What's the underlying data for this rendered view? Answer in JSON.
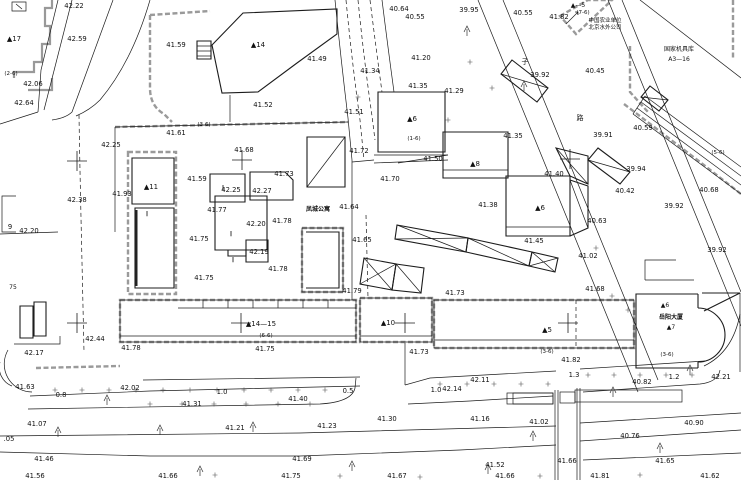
{
  "drawing": {
    "type": "cadastral-survey-plan",
    "colors": {
      "background": "#ffffff",
      "ink": "#1c1c1c",
      "screen_gray": "#9a9a9a"
    },
    "labels": [
      {
        "t": "42.22",
        "x": 74,
        "y": 8
      },
      {
        "t": "42.59",
        "x": 77,
        "y": 41
      },
      {
        "t": "▲17",
        "x": 14,
        "y": 41,
        "s": 7
      },
      {
        "t": "(2-6)",
        "x": 11,
        "y": 75,
        "s": 5.5
      },
      {
        "t": "42.06",
        "x": 33,
        "y": 86
      },
      {
        "t": "42.64",
        "x": 24,
        "y": 105
      },
      {
        "t": "41.59",
        "x": 176,
        "y": 47
      },
      {
        "t": "▲14",
        "x": 258,
        "y": 47,
        "s": 7
      },
      {
        "t": "(3-6)",
        "x": 204,
        "y": 126,
        "s": 5.5
      },
      {
        "t": "41.61",
        "x": 176,
        "y": 135
      },
      {
        "t": "42.25",
        "x": 111,
        "y": 147
      },
      {
        "t": "41.49",
        "x": 317,
        "y": 61
      },
      {
        "t": "41.52",
        "x": 263,
        "y": 107
      },
      {
        "t": "41.51",
        "x": 354,
        "y": 114
      },
      {
        "t": "42.38",
        "x": 77,
        "y": 202
      },
      {
        "t": "42.20",
        "x": 29,
        "y": 233
      },
      {
        "t": "41.93",
        "x": 122,
        "y": 196
      },
      {
        "t": "▲11",
        "x": 151,
        "y": 189,
        "s": 7
      },
      {
        "t": "9",
        "x": 10,
        "y": 229
      },
      {
        "t": "75",
        "x": 13,
        "y": 289,
        "s": 6
      },
      {
        "t": "41.59",
        "x": 197,
        "y": 181
      },
      {
        "t": "42.25",
        "x": 231,
        "y": 192
      },
      {
        "t": "42.27",
        "x": 262,
        "y": 193
      },
      {
        "t": "41.77",
        "x": 217,
        "y": 212
      },
      {
        "t": "42.20",
        "x": 256,
        "y": 226
      },
      {
        "t": "41.78",
        "x": 282,
        "y": 223
      },
      {
        "t": "41.75",
        "x": 199,
        "y": 241
      },
      {
        "t": "42.19",
        "x": 259,
        "y": 254
      },
      {
        "t": "41.78",
        "x": 278,
        "y": 271
      },
      {
        "t": "41.75",
        "x": 204,
        "y": 280
      },
      {
        "t": "41.68",
        "x": 244,
        "y": 152
      },
      {
        "t": "41.73",
        "x": 284,
        "y": 176
      },
      {
        "t": "凤城公寓",
        "x": 318,
        "y": 211,
        "s": 6,
        "w": "bold"
      },
      {
        "t": "41.64",
        "x": 349,
        "y": 209
      },
      {
        "t": "41.72",
        "x": 359,
        "y": 153
      },
      {
        "t": "41.70",
        "x": 390,
        "y": 181
      },
      {
        "t": "41.65",
        "x": 362,
        "y": 242
      },
      {
        "t": "41.79",
        "x": 352,
        "y": 293
      },
      {
        "t": "41.73",
        "x": 455,
        "y": 295
      },
      {
        "t": "40.64",
        "x": 399,
        "y": 11
      },
      {
        "t": "40.55",
        "x": 415,
        "y": 19
      },
      {
        "t": "39.95",
        "x": 469,
        "y": 12
      },
      {
        "t": "40.55",
        "x": 523,
        "y": 15
      },
      {
        "t": "41.82",
        "x": 559,
        "y": 19
      },
      {
        "t": "▲—5",
        "x": 578,
        "y": 7,
        "s": 6
      },
      {
        "t": "(7-6)",
        "x": 583,
        "y": 14,
        "s": 5.5
      },
      {
        "t": "中国农业单位",
        "x": 605,
        "y": 22,
        "s": 5.5
      },
      {
        "t": "北京水外公司",
        "x": 605,
        "y": 29,
        "s": 5.5
      },
      {
        "t": "国家机具库",
        "x": 679,
        "y": 51,
        "s": 6
      },
      {
        "t": "A3—16",
        "x": 679,
        "y": 61,
        "s": 6
      },
      {
        "t": "41.34",
        "x": 370,
        "y": 73
      },
      {
        "t": "41.20",
        "x": 421,
        "y": 60
      },
      {
        "t": "41.29",
        "x": 454,
        "y": 93
      },
      {
        "t": "41.35",
        "x": 418,
        "y": 88
      },
      {
        "t": "▲6",
        "x": 412,
        "y": 121,
        "s": 7
      },
      {
        "t": "41.35",
        "x": 513,
        "y": 138
      },
      {
        "t": "(1-6)",
        "x": 414,
        "y": 140,
        "s": 5.5
      },
      {
        "t": "41.50",
        "x": 433,
        "y": 161
      },
      {
        "t": "▲8",
        "x": 475,
        "y": 166,
        "s": 7
      },
      {
        "t": "41.40",
        "x": 554,
        "y": 176
      },
      {
        "t": "41.38",
        "x": 488,
        "y": 207
      },
      {
        "t": "▲6",
        "x": 540,
        "y": 210,
        "s": 7
      },
      {
        "t": "41.45",
        "x": 534,
        "y": 243
      },
      {
        "t": "41.02",
        "x": 588,
        "y": 258
      },
      {
        "t": "39.92",
        "x": 540,
        "y": 77
      },
      {
        "t": "子",
        "x": 525,
        "y": 64,
        "s": 7
      },
      {
        "t": "路",
        "x": 580,
        "y": 120,
        "s": 7
      },
      {
        "t": "40.45",
        "x": 595,
        "y": 73
      },
      {
        "t": "39.91",
        "x": 603,
        "y": 137
      },
      {
        "t": "40.59",
        "x": 643,
        "y": 130
      },
      {
        "t": "39.94",
        "x": 636,
        "y": 171
      },
      {
        "t": "40.42",
        "x": 625,
        "y": 193
      },
      {
        "t": "39.92",
        "x": 674,
        "y": 208
      },
      {
        "t": "40.68",
        "x": 709,
        "y": 192
      },
      {
        "t": "39.92",
        "x": 717,
        "y": 252
      },
      {
        "t": "(5-6)",
        "x": 718,
        "y": 154,
        "s": 5.5
      },
      {
        "t": "40.63",
        "x": 597,
        "y": 223
      },
      {
        "t": "41.68",
        "x": 595,
        "y": 291
      },
      {
        "t": "42.44",
        "x": 95,
        "y": 341
      },
      {
        "t": "42.17",
        "x": 34,
        "y": 355
      },
      {
        "t": "41.78",
        "x": 131,
        "y": 350
      },
      {
        "t": "41.63",
        "x": 25,
        "y": 389
      },
      {
        "t": "42.02",
        "x": 130,
        "y": 390
      },
      {
        "t": "0.8",
        "x": 61,
        "y": 397
      },
      {
        "t": "1.0",
        "x": 222,
        "y": 394
      },
      {
        "t": "41.31",
        "x": 192,
        "y": 406
      },
      {
        "t": "41.07",
        "x": 37,
        "y": 426
      },
      {
        "t": "41.21",
        "x": 235,
        "y": 430
      },
      {
        "t": ".05",
        "x": 9,
        "y": 441
      },
      {
        "t": "41.46",
        "x": 44,
        "y": 461
      },
      {
        "t": "41.56",
        "x": 35,
        "y": 478
      },
      {
        "t": "41.66",
        "x": 168,
        "y": 478
      },
      {
        "t": "▲14—15",
        "x": 261,
        "y": 326,
        "s": 7
      },
      {
        "t": "(6-6)",
        "x": 266,
        "y": 337,
        "s": 5.5
      },
      {
        "t": "41.75",
        "x": 265,
        "y": 351
      },
      {
        "t": "▲10",
        "x": 388,
        "y": 325,
        "s": 7
      },
      {
        "t": "41.73",
        "x": 419,
        "y": 354
      },
      {
        "t": "0.5",
        "x": 348,
        "y": 393
      },
      {
        "t": "41.40",
        "x": 298,
        "y": 401
      },
      {
        "t": "1.0",
        "x": 436,
        "y": 392
      },
      {
        "t": "42.14",
        "x": 452,
        "y": 391
      },
      {
        "t": "42.11",
        "x": 480,
        "y": 382
      },
      {
        "t": "41.30",
        "x": 387,
        "y": 421
      },
      {
        "t": "41.16",
        "x": 480,
        "y": 421
      },
      {
        "t": "41.23",
        "x": 327,
        "y": 428
      },
      {
        "t": "41.69",
        "x": 302,
        "y": 461
      },
      {
        "t": "41.75",
        "x": 291,
        "y": 478
      },
      {
        "t": "41.67",
        "x": 397,
        "y": 478
      },
      {
        "t": "▲5",
        "x": 547,
        "y": 332,
        "s": 7
      },
      {
        "t": "(3-6)",
        "x": 547,
        "y": 353,
        "s": 5.5
      },
      {
        "t": "41.82",
        "x": 571,
        "y": 362
      },
      {
        "t": "▲6",
        "x": 665,
        "y": 307,
        "s": 6
      },
      {
        "t": "岳阳大厦",
        "x": 671,
        "y": 319,
        "s": 6,
        "w": "bold"
      },
      {
        "t": "▲7",
        "x": 671,
        "y": 329,
        "s": 6
      },
      {
        "t": "(3-6)",
        "x": 667,
        "y": 356,
        "s": 5.5
      },
      {
        "t": "1.3",
        "x": 574,
        "y": 377
      },
      {
        "t": "1.2",
        "x": 674,
        "y": 379
      },
      {
        "t": "42.21",
        "x": 721,
        "y": 379
      },
      {
        "t": "40.82",
        "x": 642,
        "y": 384
      },
      {
        "t": "41.02",
        "x": 539,
        "y": 424
      },
      {
        "t": "40.90",
        "x": 694,
        "y": 425
      },
      {
        "t": "40.76",
        "x": 630,
        "y": 438
      },
      {
        "t": "41.52",
        "x": 495,
        "y": 467
      },
      {
        "t": "41.66",
        "x": 567,
        "y": 463
      },
      {
        "t": "41.66",
        "x": 505,
        "y": 478
      },
      {
        "t": "41.81",
        "x": 600,
        "y": 478
      },
      {
        "t": "41.65",
        "x": 665,
        "y": 463
      },
      {
        "t": "41.62",
        "x": 710,
        "y": 478
      },
      {
        "t": "‖",
        "x": 147,
        "y": 215,
        "s": 5
      },
      {
        "t": "‖",
        "x": 223,
        "y": 189,
        "s": 5
      },
      {
        "t": "‖",
        "x": 231,
        "y": 235,
        "s": 5
      },
      {
        "t": "‖",
        "x": 233,
        "y": 261,
        "s": 5
      }
    ],
    "crosses": [
      [
        77,
        161
      ],
      [
        242,
        160
      ],
      [
        570,
        159
      ],
      [
        77,
        323
      ],
      [
        241,
        323
      ],
      [
        405,
        323
      ],
      [
        568,
        323
      ]
    ],
    "plus_rows": [
      {
        "y": 390,
        "x1": 55,
        "x2": 345,
        "step": 27
      },
      {
        "y": 404,
        "x1": 150,
        "x2": 340,
        "step": 32
      },
      {
        "y": 384,
        "x1": 440,
        "x2": 548,
        "step": 27
      },
      {
        "y": 375,
        "x1": 588,
        "x2": 715,
        "step": 26
      }
    ],
    "plus_points": [
      [
        358,
        97
      ],
      [
        470,
        62
      ],
      [
        492,
        88
      ],
      [
        448,
        120
      ],
      [
        612,
        296
      ],
      [
        628,
        310
      ],
      [
        596,
        248
      ],
      [
        215,
        475
      ],
      [
        340,
        476
      ],
      [
        420,
        477
      ],
      [
        540,
        476
      ],
      [
        640,
        475
      ]
    ],
    "trees": [
      [
        58,
        433
      ],
      [
        160,
        431
      ],
      [
        253,
        428
      ],
      [
        352,
        467
      ],
      [
        533,
        437
      ],
      [
        613,
        393
      ],
      [
        660,
        449
      ],
      [
        690,
        371
      ],
      [
        467,
        32
      ],
      [
        524,
        87
      ],
      [
        107,
        401
      ],
      [
        488,
        470
      ],
      [
        200,
        472
      ]
    ]
  }
}
